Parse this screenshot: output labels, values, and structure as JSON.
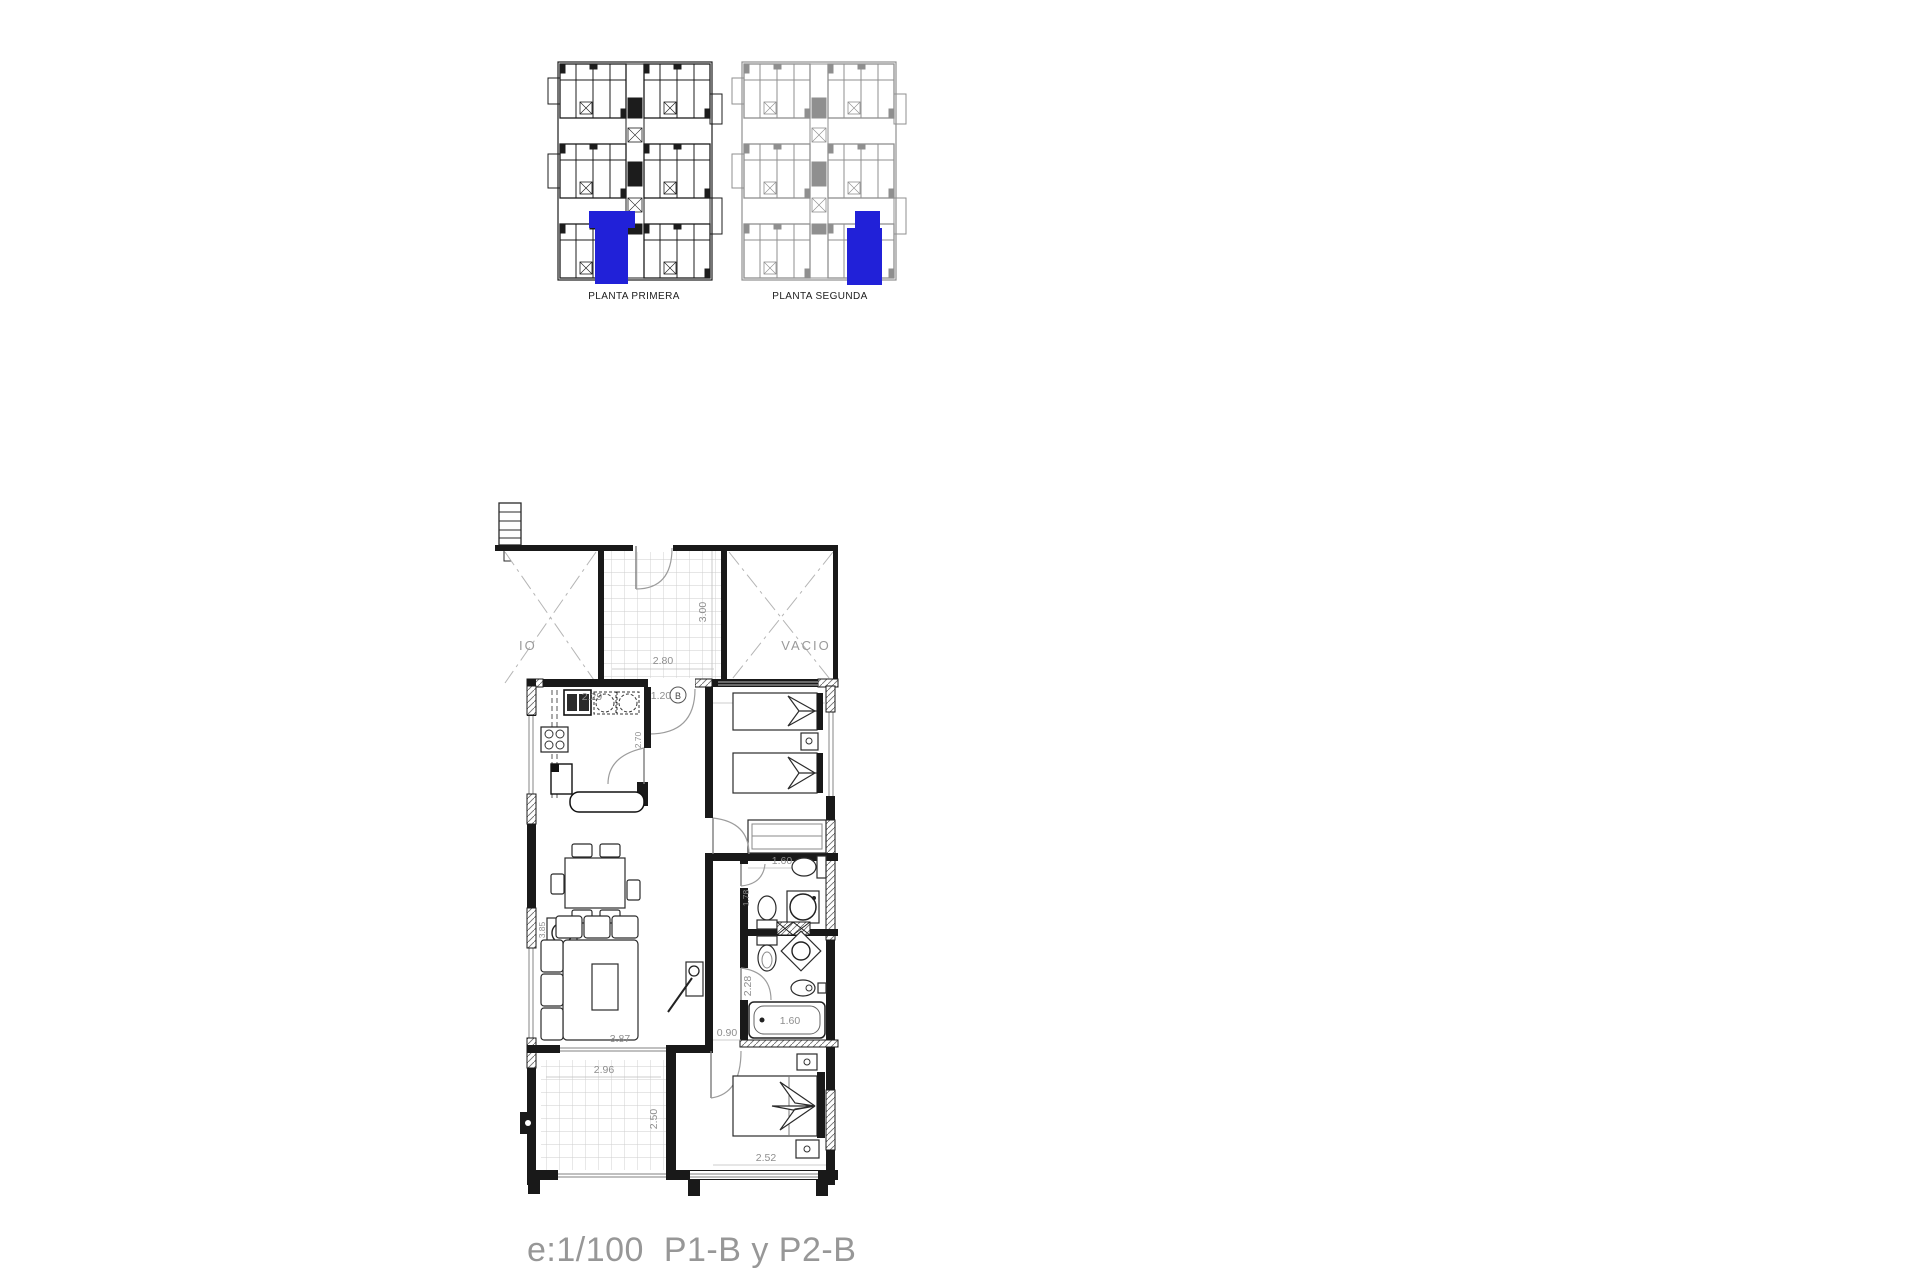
{
  "colors": {
    "highlight_blue": "#2121d8",
    "line_dark": "#191919",
    "dim_text": "#8e8e8e",
    "caption_gray": "#979797"
  },
  "overview": {
    "plans": [
      {
        "label": "PLANTA PRIMERA"
      },
      {
        "label": "PLANTA SEGUNDA"
      }
    ]
  },
  "floor_plan": {
    "labels": {
      "void_right": "VACIO",
      "void_left_clipped": "IO",
      "door_tag": "B"
    },
    "dims": {
      "porch_width": "2.80",
      "porch_depth": "3.00",
      "kitchen_top": "2.29",
      "kitchen_side": "2.70",
      "entrance": "1.20",
      "bedroom2_width": "2.52",
      "bath_top_width": "1.60",
      "bath_side": "1.78",
      "bath_corridor": "2.28",
      "tub": "1.60",
      "hall_width": "0.90",
      "living_width": "3.87",
      "living_side": "3.85",
      "terrace_width": "2.96",
      "terrace_depth": "2.50",
      "bedroom1_width": "2.52"
    }
  },
  "caption": {
    "scale_and_units": "e:1/100  P1-B y P2-B"
  }
}
